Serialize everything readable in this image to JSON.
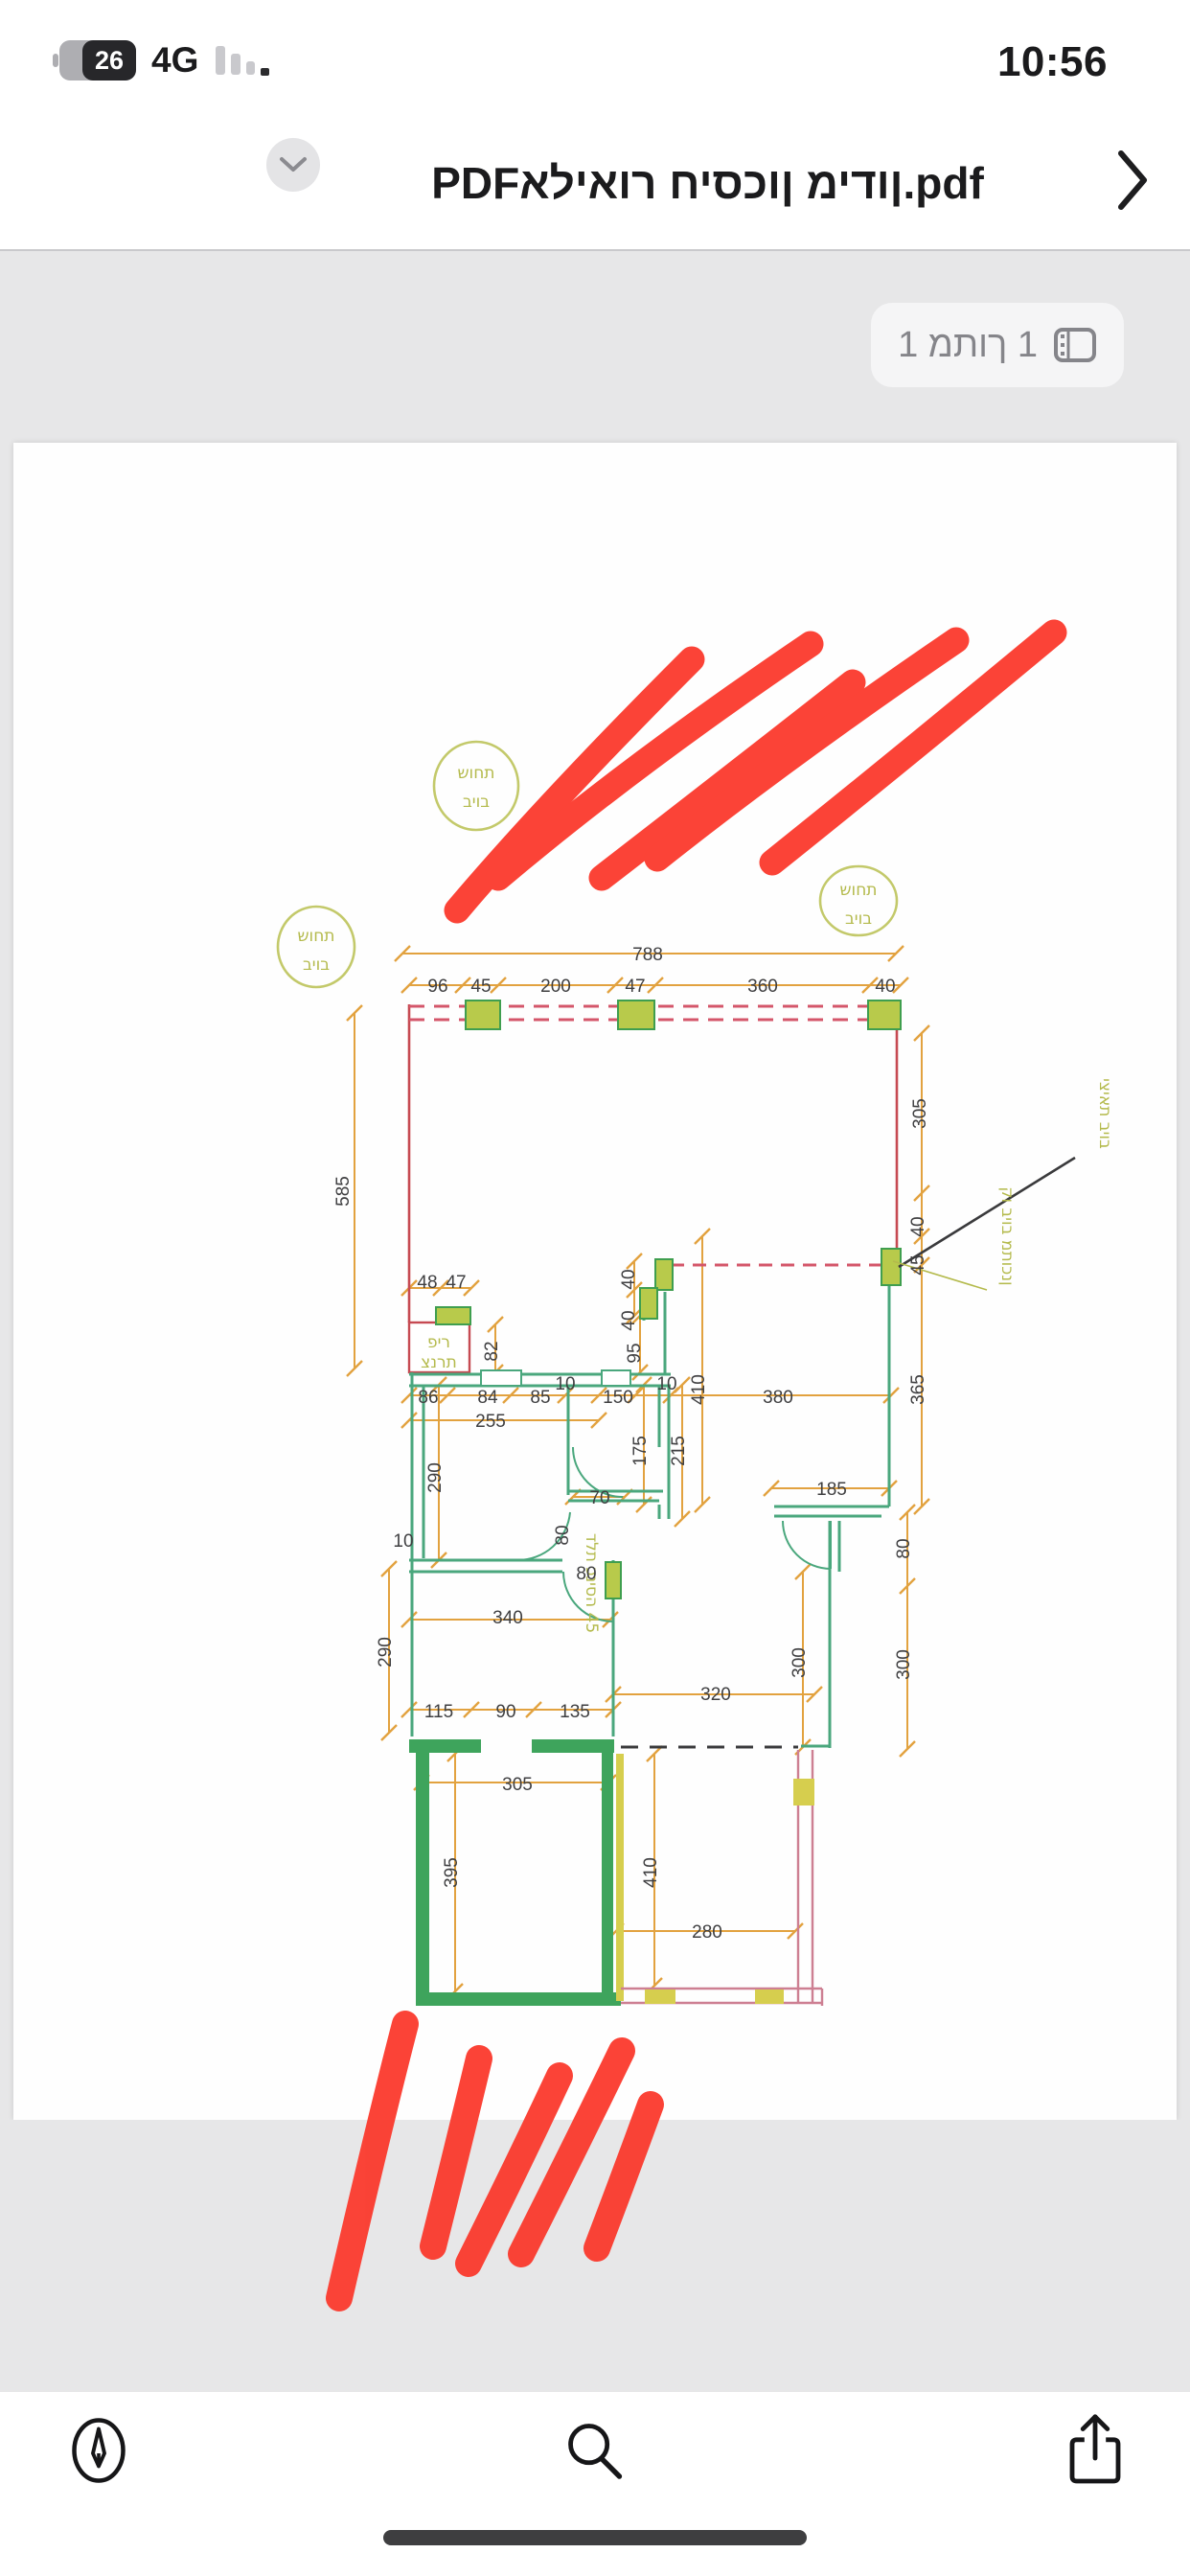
{
  "status": {
    "time": "10:56",
    "battery_percent": "26",
    "network": "4G"
  },
  "titlebar": {
    "prefix": "PDF ",
    "hebrew_name": "אליאור חיסכון מידון",
    "suffix": ".pdf"
  },
  "pager": {
    "label": "1 מתוך 1"
  },
  "plan": {
    "manhole": {
      "l1": "שוחת",
      "l2": "ביוב"
    },
    "pir": {
      "l1": "פיר",
      "l2": "צנרת"
    },
    "notes": {
      "outlet": "יציאת ביוב",
      "sewer": "קו ביוב מתוכנן",
      "door": "דלת כניסה 45"
    },
    "dims": [
      "788",
      "96",
      "45",
      "200",
      "47",
      "360",
      "40",
      "585",
      "305",
      "40",
      "45",
      "365",
      "48",
      "47",
      "82",
      "40",
      "40",
      "95",
      "86",
      "84",
      "85",
      "10",
      "150",
      "10",
      "380",
      "255",
      "175",
      "215",
      "410",
      "290",
      "70",
      "185",
      "80",
      "10",
      "80",
      "340",
      "290",
      "80",
      "300",
      "300",
      "320",
      "115",
      "90",
      "135",
      "305",
      "395",
      "410",
      "280"
    ]
  },
  "colors": {
    "marker_red": "#fb3a2d",
    "dim_orange": "#e2a23f",
    "wall_red": "#c64a52",
    "wall_teal": "#4aa77d",
    "wall_green": "#3ea45c",
    "window_fill": "#b8ca4b",
    "olive": "#b4ba4c",
    "wall_pink": "#cd7f92",
    "accent_yellow": "#d6ce4e"
  }
}
